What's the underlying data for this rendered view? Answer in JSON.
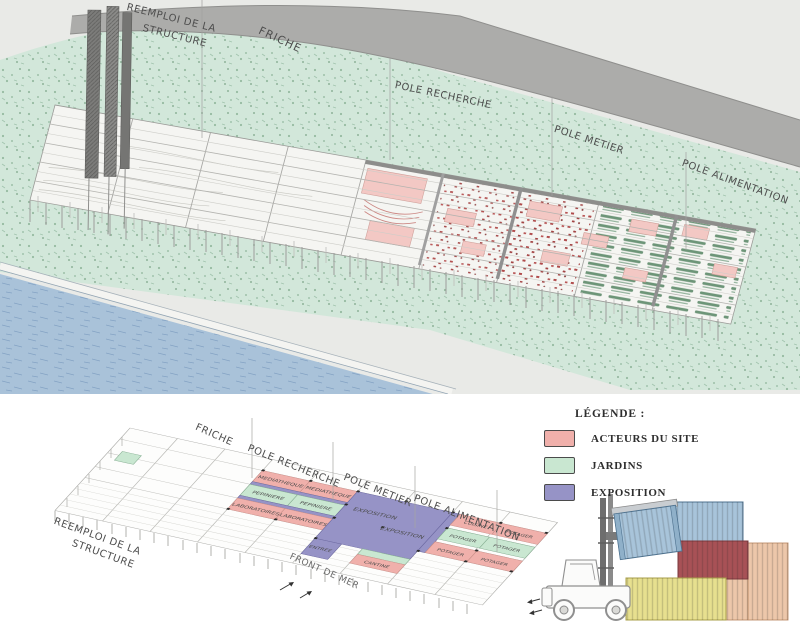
{
  "top": {
    "labels": {
      "reemploi_1": "REEMPLOI DE LA",
      "reemploi_2": "STRUCTURE",
      "friche": "FRICHE",
      "recherche": "POLE RECHERCHE",
      "metier": "POLE METIER",
      "alimentation": "POLE ALIMENTATION"
    }
  },
  "bottom": {
    "diagram": {
      "labels": {
        "friche": "FRICHE",
        "recherche": "POLE RECHERCHE",
        "metier": "POLE METIER",
        "alimentation": "POLE ALIMENTATION",
        "reemploi_1": "REEMPLOI DE LA",
        "reemploi_2": "STRUCTURE",
        "front_de_mer": "FRONT DE MER"
      },
      "zones": [
        {
          "label": "MEDIATHEQUE",
          "type": "acteurs"
        },
        {
          "label": "MEDIATHEQUE",
          "type": "acteurs"
        },
        {
          "label": "PEPINIERE",
          "type": "jardins"
        },
        {
          "label": "PEPINIERE",
          "type": "jardins"
        },
        {
          "label": "LABORATOIRES",
          "type": "acteurs"
        },
        {
          "label": "LABORATOIRES",
          "type": "acteurs"
        },
        {
          "label": "EXPOSITION",
          "type": "exposition"
        },
        {
          "label": "EXPOSITION",
          "type": "exposition"
        },
        {
          "label": "ENTREE",
          "type": "exposition"
        },
        {
          "label": "CANTINE",
          "type": "acteurs"
        },
        {
          "label": "CUISINE",
          "type": "acteurs"
        },
        {
          "label": "POTAGER",
          "type": "jardins"
        },
        {
          "label": "POTAGER",
          "type": "acteurs"
        },
        {
          "label": "POTAGER",
          "type": "acteurs"
        },
        {
          "label": "POTAGER",
          "type": "jardins"
        },
        {
          "label": "POTAGER",
          "type": "acteurs"
        }
      ]
    },
    "legend": {
      "title": "LÉGENDE :",
      "items": [
        {
          "label": "ACTEURS DU SITE",
          "color": "#f0b0ab"
        },
        {
          "label": "JARDINS",
          "color": "#c9e7d1"
        },
        {
          "label": "EXPOSITION",
          "color": "#9693c6"
        }
      ]
    }
  }
}
